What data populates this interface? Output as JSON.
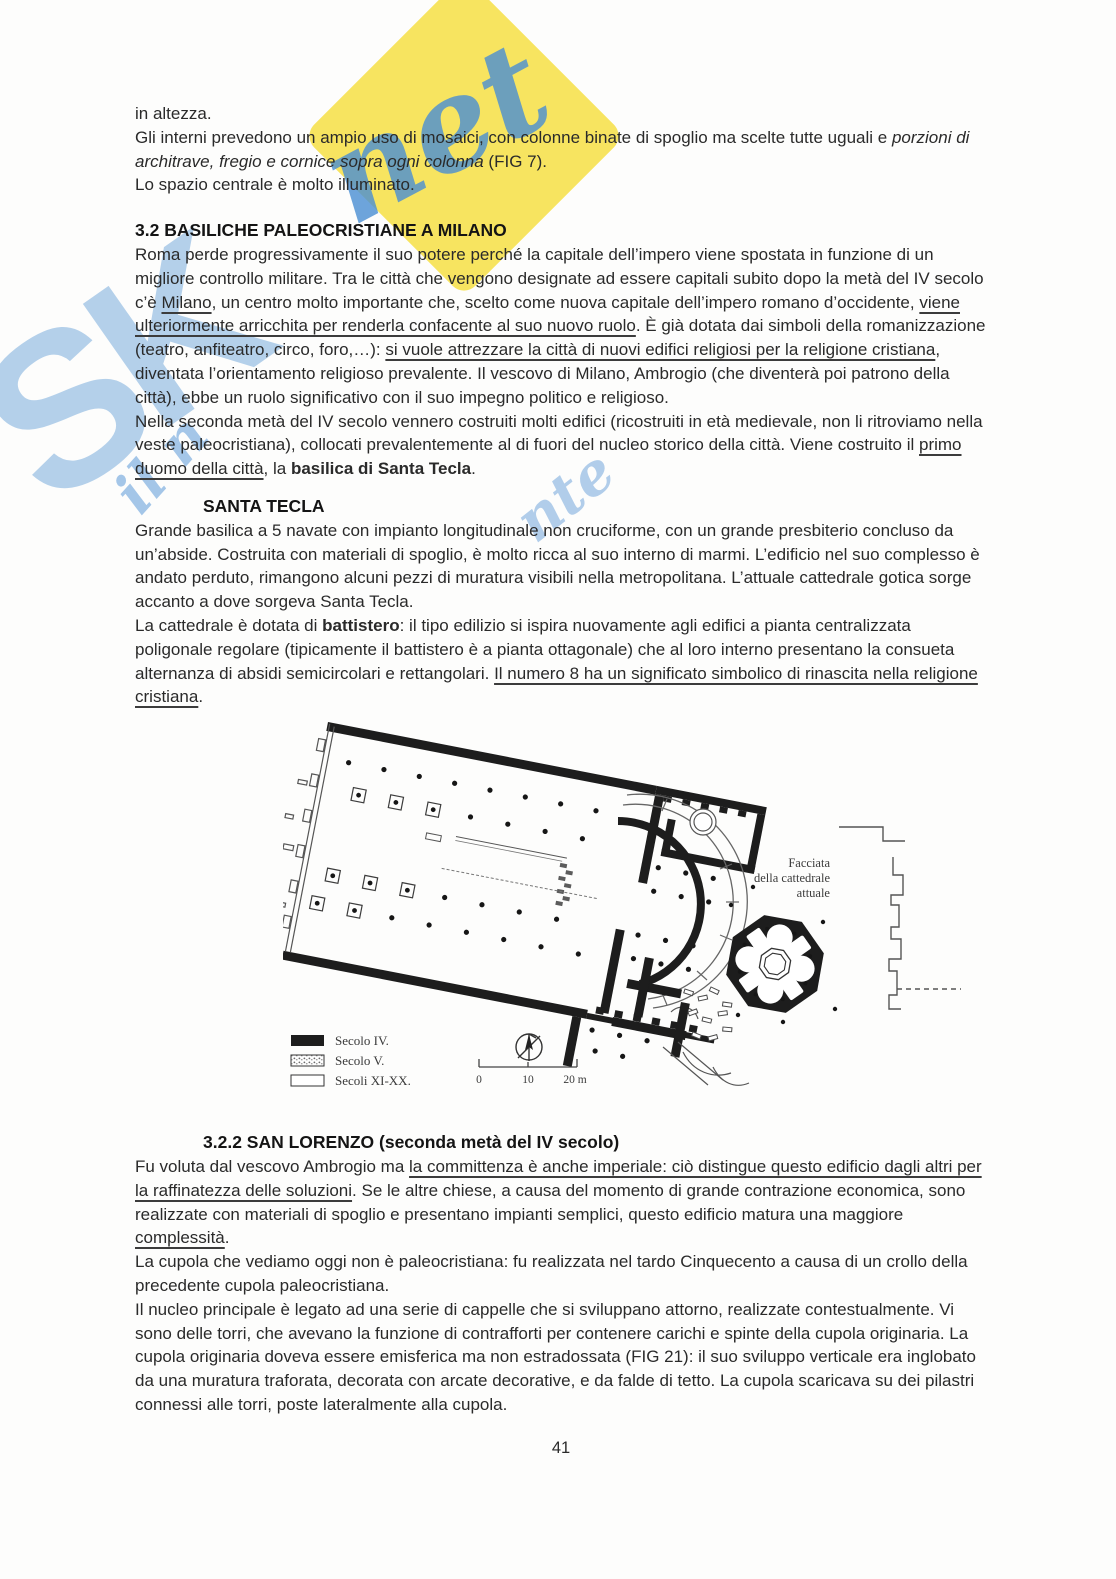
{
  "page": {
    "number": "41"
  },
  "watermark": {
    "big_letters": "SK",
    "script_fragments": [
      "net",
      "il n",
      "nte"
    ],
    "yellow_color": "#f7e35a",
    "script_blue": "#4a8fd3",
    "letter_blue": "#5d9bd6"
  },
  "content": {
    "blocks": [
      {
        "type": "p",
        "segments": [
          {
            "t": "in altezza."
          }
        ]
      },
      {
        "type": "p",
        "segments": [
          {
            "t": "Gli interni prevedono un ampio uso di mosaici, con colonne binate di spoglio ma scelte tutte uguali e "
          },
          {
            "t": "porzioni di architrave, fregio e cornice sopra ogni colonna",
            "f": "i"
          },
          {
            "t": " (FIG 7)."
          }
        ]
      },
      {
        "type": "p",
        "segments": [
          {
            "t": "Lo spazio centrale è molto illuminato."
          }
        ]
      },
      {
        "type": "h2",
        "segments": [
          {
            "t": "3.2 BASILICHE PALEOCRISTIANE A MILANO"
          }
        ]
      },
      {
        "type": "p",
        "segments": [
          {
            "t": "Roma perde progressivamente il suo potere perché la capitale dell’impero viene spostata in funzione di un migliore controllo militare. Tra le città che vengono designate ad essere capitali subito dopo la metà del IV secolo c’è "
          },
          {
            "t": "Milano",
            "f": "u"
          },
          {
            "t": ", un centro molto importante che, scelto come nuova capitale dell’impero romano d’occidente, "
          },
          {
            "t": "viene ulteriormente arricchita per renderla confacente al suo nuovo ruolo",
            "f": "u"
          },
          {
            "t": ". È già dotata dai simboli della romanizzazione (teatro, anfiteatro, circo, foro,…): "
          },
          {
            "t": "si vuole attrezzare la città di nuovi edifici religiosi per la religione cristiana",
            "f": "u"
          },
          {
            "t": ", diventata l’orientamento religioso prevalente. Il vescovo di Milano, Ambrogio (che diventerà poi patrono della città), ebbe un ruolo significativo con il suo impegno politico e religioso."
          }
        ]
      },
      {
        "type": "p",
        "segments": [
          {
            "t": "Nella seconda metà del IV secolo vennero costruiti molti edifici (ricostruiti in età medievale, non li ritroviamo nella veste paleocristiana), collocati prevalentemente al di fuori del nucleo storico della città. Viene costruito il "
          },
          {
            "t": "primo duomo della città",
            "f": "u"
          },
          {
            "t": ", la "
          },
          {
            "t": "basilica di Santa Tecla",
            "f": "b"
          },
          {
            "t": "."
          }
        ]
      },
      {
        "type": "h3",
        "segments": [
          {
            "t": "SANTA TECLA"
          }
        ]
      },
      {
        "type": "p",
        "segments": [
          {
            "t": "Grande basilica a 5 navate con impianto longitudinale non cruciforme, con un grande presbiterio concluso da un’abside. Costruita con materiali di spoglio, è molto ricca al suo interno di marmi. L’edificio nel suo complesso è andato perduto, rimangono alcuni pezzi di muratura visibili nella metropolitana. L’attuale cattedrale gotica sorge accanto a dove sorgeva Santa Tecla."
          }
        ]
      },
      {
        "type": "p",
        "segments": [
          {
            "t": "La cattedrale è dotata di "
          },
          {
            "t": "battistero",
            "f": "b"
          },
          {
            "t": ": il tipo edilizio si ispira nuovamente agli edifici a pianta centralizzata poligonale regolare (tipicamente il battistero è a pianta ottagonale) che al loro interno presentano la consueta alternanza di absidi semicircolari e rettangolari. "
          },
          {
            "t": "Il numero 8 ha un significato simbolico di rinascita nella religione cristiana",
            "f": "u"
          },
          {
            "t": "."
          }
        ]
      },
      {
        "type": "h3",
        "segments": [
          {
            "t": "3.2.2 SAN LORENZO (seconda metà del IV secolo)"
          }
        ]
      },
      {
        "type": "p",
        "segments": [
          {
            "t": "Fu voluta dal vescovo Ambrogio ma "
          },
          {
            "t": "la committenza è anche imperiale: ciò distingue questo edificio dagli altri per la raffinatezza delle soluzioni",
            "f": "u"
          },
          {
            "t": ". Se le altre chiese, a causa del momento di grande contrazione economica, sono realizzate con materiali di spoglio e presentano impianti semplici, questo edificio matura una maggiore "
          },
          {
            "t": "complessità",
            "f": "u"
          },
          {
            "t": "."
          }
        ]
      },
      {
        "type": "p",
        "segments": [
          {
            "t": "La cupola che vediamo oggi non è paleocristiana: fu realizzata nel tardo Cinquecento a causa di un crollo della precedente cupola paleocristiana."
          }
        ]
      },
      {
        "type": "p",
        "segments": [
          {
            "t": "Il nucleo principale è legato ad una serie di cappelle che si sviluppano attorno, realizzate contestualmente. Vi sono delle torri, che avevano la funzione di contrafforti per contenere carichi e spinte della cupola originaria. La cupola originaria doveva essere emisferica ma non estradossata (FIG 21): il suo sviluppo verticale era inglobato da una muratura traforata, decorata con arcate decorative, e da falde di tetto. La cupola scaricava su dei pilastri connessi alle torri, poste lateralmente alla cupola."
          }
        ]
      }
    ]
  },
  "figure": {
    "facade_label_lines": [
      "Facciata",
      "della cattedrale",
      "attuale"
    ],
    "legend": [
      {
        "swatch": "solid-black",
        "label": "Secolo IV."
      },
      {
        "swatch": "stippled",
        "label": "Secolo V."
      },
      {
        "swatch": "outline",
        "label": "Secoli XI-XX."
      }
    ],
    "scale_labels": [
      "0",
      "10",
      "20 m"
    ],
    "compass": "north-arrow"
  }
}
